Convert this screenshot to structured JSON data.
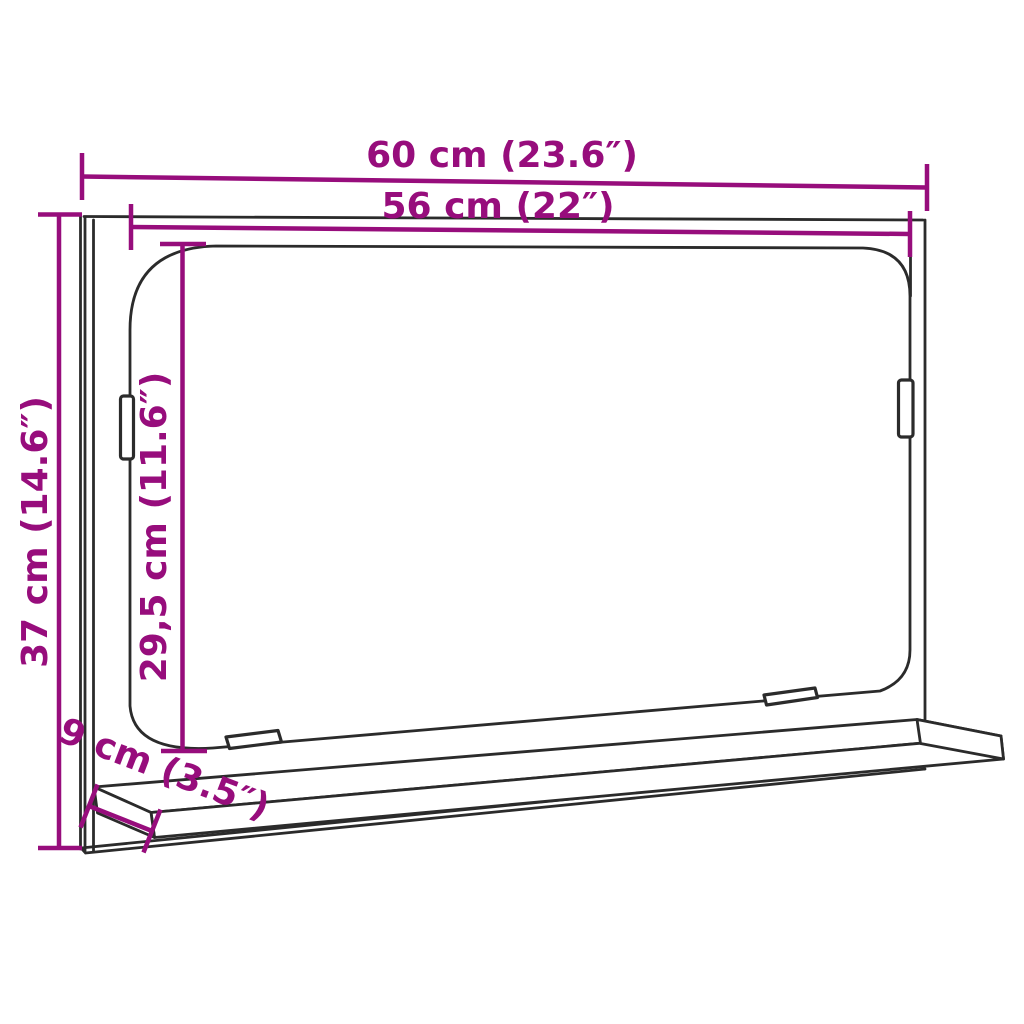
{
  "diagram": {
    "subject": "wall mirror with shelf — product dimension drawing",
    "colors": {
      "dimension_accent": "#970D7C",
      "outline": "#2B2B2B",
      "background": "#FFFFFF"
    },
    "dimensions": {
      "outer_width": {
        "label": "60 cm (23.6″)",
        "cm": "60",
        "inches": "23.6"
      },
      "mirror_width": {
        "label": "56 cm (22″)",
        "cm": "56",
        "inches": "22"
      },
      "outer_height": {
        "label": "37 cm (14.6″)",
        "cm": "37",
        "inches": "14.6"
      },
      "mirror_height": {
        "label": "29,5 cm (11.6″)",
        "cm": "29,5",
        "inches": "11.6"
      },
      "shelf_depth": {
        "label": "9 cm (3.5″)",
        "cm": "9",
        "inches": "3.5"
      }
    }
  }
}
